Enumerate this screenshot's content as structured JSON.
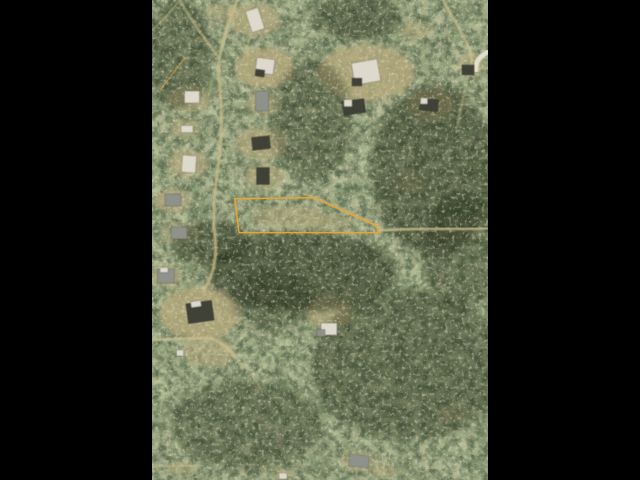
{
  "scene": {
    "description": "Letterboxed aerial satellite photo of a wooded residential area with a highlighted property parcel outlined in orange",
    "photo": {
      "left": 152,
      "top": 0,
      "width": 336,
      "height": 480
    }
  },
  "palette": {
    "letterbox": "#000000",
    "ground_base": "#5d6545",
    "clearing": "#b3a87c",
    "grove": "#222b18",
    "road": "#c9bd8e",
    "road_bright": "#ece6d6",
    "roof_white": "#ddd9cd",
    "roof_gray": "#8e928a",
    "roof_dark": "#3f4239",
    "parcel_outline": "#eca42e"
  },
  "parcel": {
    "label": "highlighted parcel boundary",
    "points": "82.7,198.7 162,197.7 224.7,225.7 227.3,232.7 87,232.7",
    "stroke_width": 1.4
  },
  "partial_parcel": {
    "label": "edge of adjacent parcel outline",
    "x1": 33,
    "y1": 58,
    "x2": 8,
    "y2": 90,
    "stroke_width": 1.2,
    "opacity": 0.55
  },
  "clearings": [
    [
      102,
      20,
      26,
      16,
      0.8
    ],
    [
      70,
      12,
      16,
      10,
      0.5
    ],
    [
      113,
      68,
      30,
      20,
      0.85
    ],
    [
      38,
      99,
      22,
      13,
      0.7
    ],
    [
      33,
      128,
      16,
      9,
      0.6
    ],
    [
      36,
      164,
      20,
      14,
      0.7
    ],
    [
      20,
      201,
      18,
      12,
      0.7
    ],
    [
      110,
      104,
      16,
      12,
      0.6
    ],
    [
      110,
      144,
      26,
      16,
      0.7
    ],
    [
      112,
      177,
      20,
      13,
      0.65
    ],
    [
      214,
      73,
      48,
      28,
      0.85
    ],
    [
      279,
      104,
      24,
      14,
      0.7
    ],
    [
      263,
      31,
      15,
      10,
      0.5
    ],
    [
      319,
      64,
      14,
      12,
      0.6
    ],
    [
      137,
      217,
      38,
      12,
      0.55
    ],
    [
      176,
      224,
      26,
      9,
      0.45
    ],
    [
      48,
      313,
      40,
      26,
      0.85
    ],
    [
      14,
      276,
      16,
      12,
      0.6
    ],
    [
      178,
      313,
      24,
      16,
      0.75
    ],
    [
      57,
      352,
      26,
      16,
      0.6
    ],
    [
      207,
      461,
      18,
      10,
      0.55
    ],
    [
      230,
      470,
      16,
      8,
      0.45
    ],
    [
      131,
      475,
      10,
      6,
      0.6
    ],
    [
      30,
      468,
      14,
      7,
      0.5
    ],
    [
      300,
      413,
      14,
      9,
      0.4
    ],
    [
      258,
      182,
      18,
      9,
      0.4
    ],
    [
      26,
      233,
      18,
      10,
      0.5
    ]
  ],
  "groves": [
    [
      150,
      272,
      95,
      40,
      0.5
    ],
    [
      282,
      170,
      62,
      85,
      0.45
    ],
    [
      255,
      365,
      95,
      75,
      0.4
    ],
    [
      95,
      425,
      75,
      45,
      0.35
    ],
    [
      25,
      55,
      35,
      55,
      0.35
    ],
    [
      160,
      120,
      40,
      60,
      0.35
    ],
    [
      310,
      250,
      40,
      60,
      0.35
    ],
    [
      60,
      243,
      40,
      22,
      0.45
    ],
    [
      205,
      18,
      45,
      22,
      0.4
    ],
    [
      120,
      300,
      40,
      30,
      0.3
    ]
  ],
  "roads": [
    {
      "d": "M 85,0 C 76,28 64,52 67,80 C 70,106 71,132 67,160 C 63,188 60,212 63,236 C 65,258 62,274 52,290",
      "w": 3,
      "o": 0.75
    },
    {
      "d": "M 28,0 C 36,16 52,38 67,58",
      "w": 2.5,
      "o": 0.6
    },
    {
      "d": "M 0,30 C 10,22 20,10 26,2",
      "w": 2,
      "o": 0.5
    },
    {
      "d": "M 0,340 L 55,338 C 68,340 76,348 82,356",
      "w": 3,
      "o": 0.8
    },
    {
      "d": "M 228,231 C 262,227 300,230 336,228",
      "w": 3,
      "o": 0.8
    },
    {
      "d": "M 152,194 C 180,204 206,216 230,229",
      "w": 3.5,
      "o": 0.5
    },
    {
      "d": "M 291,0 C 297,12 306,24 312,38 C 317,48 319,53 320,60",
      "w": 3,
      "o": 0.7
    },
    {
      "d": "M 320,60 C 316,78 310,100 305,128",
      "w": 2.5,
      "o": 0.45
    },
    {
      "d": "M 113,88 C 116,102 116,114 113,128",
      "w": 2,
      "o": 0.4
    },
    {
      "d": "M 0,467 L 52,465",
      "w": 2.5,
      "o": 0.5
    },
    {
      "d": "M 52,290 C 60,305 68,322 78,338",
      "w": 2,
      "o": 0.4
    },
    {
      "d": "M 82,356 C 95,368 105,380 110,392",
      "w": 2,
      "o": 0.35
    },
    {
      "d": "M 336,52 C 328,56 323,62 324,70",
      "w": 5,
      "o": 0.9,
      "bright": true
    },
    {
      "d": "M 100,32 C 96,40 94,48 96,56",
      "w": 2,
      "o": 0.5
    }
  ],
  "houses": [
    [
      103,
      20,
      13,
      22,
      -18,
      "w"
    ],
    [
      113,
      66,
      18,
      15,
      8,
      "w"
    ],
    [
      108,
      73,
      9,
      7,
      8,
      "d"
    ],
    [
      40,
      97,
      15,
      12,
      0,
      "w"
    ],
    [
      35,
      129,
      12,
      7,
      0,
      "w"
    ],
    [
      37,
      164,
      14,
      17,
      4,
      "w"
    ],
    [
      21,
      200,
      16,
      12,
      0,
      "g"
    ],
    [
      110,
      101,
      13,
      20,
      0,
      "g"
    ],
    [
      109,
      143,
      18,
      13,
      -6,
      "d"
    ],
    [
      111,
      176,
      13,
      17,
      0,
      "d"
    ],
    [
      214,
      72,
      26,
      22,
      -10,
      "w"
    ],
    [
      205,
      82,
      10,
      8,
      0,
      "d"
    ],
    [
      202,
      107,
      22,
      14,
      -8,
      "d"
    ],
    [
      196,
      103,
      8,
      7,
      0,
      "w"
    ],
    [
      277,
      105,
      18,
      12,
      6,
      "d"
    ],
    [
      272,
      101,
      7,
      6,
      0,
      "w"
    ],
    [
      316,
      70,
      12,
      10,
      0,
      "d"
    ],
    [
      177,
      329,
      16,
      12,
      0,
      "w"
    ],
    [
      169,
      333,
      8,
      7,
      0,
      "g"
    ],
    [
      48,
      312,
      26,
      20,
      -8,
      "d"
    ],
    [
      44,
      304,
      10,
      6,
      -8,
      "w"
    ],
    [
      14,
      276,
      17,
      14,
      0,
      "g"
    ],
    [
      12,
      270,
      8,
      5,
      0,
      "w"
    ],
    [
      207,
      461,
      20,
      12,
      6,
      "g"
    ],
    [
      131,
      476,
      8,
      6,
      0,
      "w"
    ],
    [
      28,
      353,
      7,
      6,
      0,
      "w"
    ],
    [
      27,
      233,
      16,
      12,
      0,
      "g"
    ]
  ]
}
